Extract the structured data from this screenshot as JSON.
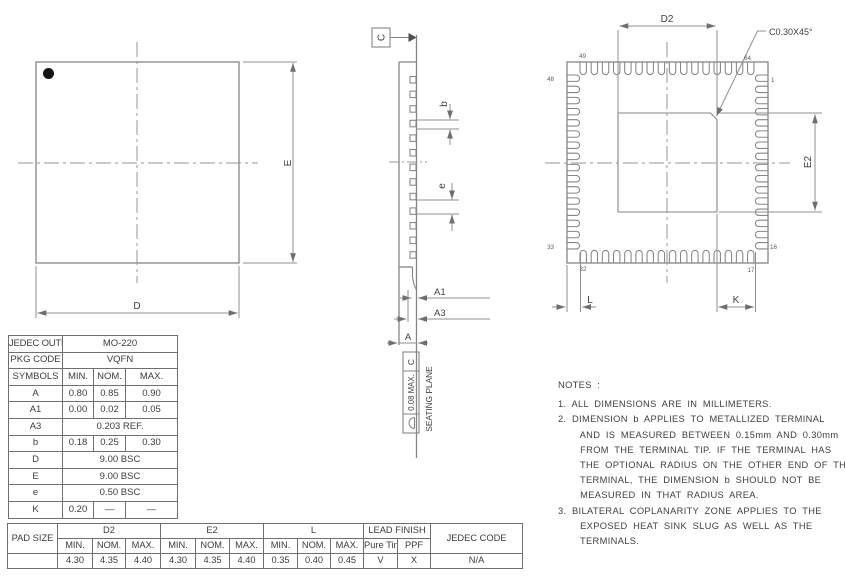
{
  "top_view": {
    "dim_d": "D",
    "dim_e": "E"
  },
  "side_view": {
    "datum_label": "C",
    "dim_b": "b",
    "dim_e": "e",
    "dim_a1": "A1",
    "dim_a3": "A3",
    "dim_a": "A",
    "flatness_tolerance": "0.08 MAX.",
    "flatness_datum": "C",
    "seating_plane": "SEATING PLANE"
  },
  "bottom_view": {
    "dim_d2": "D2",
    "dim_e2": "E2",
    "dim_l": "L",
    "dim_k": "K",
    "chamfer_callout": "C0.30X45°",
    "pin_numbers": {
      "top_left": "49",
      "top_right": "64",
      "left_top": "48",
      "right_top": "1",
      "left_bottom": "33",
      "right_bottom": "16",
      "bottom_left": "32",
      "bottom_right": "17"
    }
  },
  "spec_table": {
    "rows": [
      {
        "label": "JEDEC OUTLINE",
        "value": "MO-220"
      },
      {
        "label": "PKG CODE",
        "value": "VQFN"
      },
      {
        "label": "SYMBOLS",
        "min": "MIN.",
        "nom": "NOM.",
        "max": "MAX."
      },
      {
        "label": "A",
        "min": "0.80",
        "nom": "0.85",
        "max": "0.90"
      },
      {
        "label": "A1",
        "min": "0.00",
        "nom": "0.02",
        "max": "0.05"
      },
      {
        "label": "A3",
        "value": "0.203 REF."
      },
      {
        "label": "b",
        "min": "0.18",
        "nom": "0.25",
        "max": "0.30"
      },
      {
        "label": "D",
        "value": "9.00 BSC"
      },
      {
        "label": "E",
        "value": "9.00 BSC"
      },
      {
        "label": "e",
        "value": "0.50 BSC"
      },
      {
        "label": "K",
        "min": "0.20",
        "nom": "—",
        "max": "—"
      }
    ]
  },
  "pad_table": {
    "corner": "PAD SIZE",
    "d2": "D2",
    "e2": "E2",
    "l": "L",
    "lead_finish": "LEAD FINISH",
    "jedec": "JEDEC CODE",
    "sub": [
      "MIN.",
      "NOM.",
      "MAX.",
      "MIN.",
      "NOM.",
      "MAX.",
      "MIN.",
      "NOM.",
      "MAX.",
      "Pure Tin",
      "PPF"
    ],
    "values": [
      "",
      "4.30",
      "4.35",
      "4.40",
      "4.30",
      "4.35",
      "4.40",
      "0.35",
      "0.40",
      "0.45",
      "V",
      "X",
      "N/A"
    ]
  },
  "notes": {
    "lines": [
      "NOTES :",
      "1. ALL DIMENSIONS ARE IN MILLIMETERS.",
      "2. DIMENSION b APPLIES TO METALLIZED TERMINAL",
      "    AND IS MEASURED BETWEEN 0.15mm AND 0.30mm",
      "    FROM THE TERMINAL TIP. IF THE TERMINAL HAS",
      "    THE OPTIONAL RADIUS ON THE OTHER END OF THE",
      "    TERMINAL, THE DIMENSION b SHOULD NOT BE",
      "    MEASURED IN THAT RADIUS AREA.",
      "3. BILATERAL COPLANARITY ZONE APPLIES TO THE",
      "    EXPOSED HEAT SINK SLUG AS WELL AS THE",
      "    TERMINALS."
    ]
  }
}
